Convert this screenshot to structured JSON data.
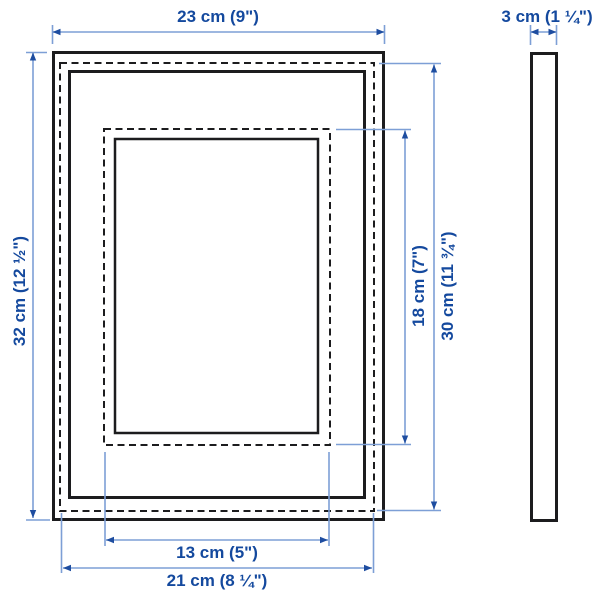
{
  "diagram": {
    "type": "product-dimension-diagram",
    "dims": {
      "outer_width": "23 cm (9\")",
      "depth": "3 cm (1 ¼\")",
      "outer_height": "32 cm (12 ½\")",
      "inner_opening_height": "18 cm (7\")",
      "picture_height": "30 cm (11 ¾\")",
      "inner_opening_width": "13 cm (5\")",
      "picture_width": "21 cm (8 ¼\")"
    },
    "colors": {
      "dimension_text": "#14499e",
      "dimension_line": "#7d9fd6",
      "arrowhead": "#1e4da0",
      "outline": "#1c1c1e",
      "background": "#ffffff"
    }
  }
}
